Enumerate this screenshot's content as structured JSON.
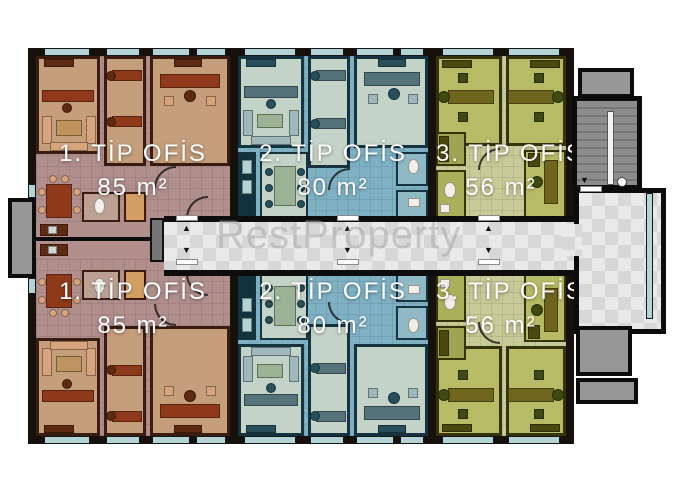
{
  "watermark": "RestProperty",
  "units": [
    {
      "id": "type1-top",
      "type_label": "1. TİP OFİS",
      "area_label": "85 m²"
    },
    {
      "id": "type2-top",
      "type_label": "2. TİP OFİS",
      "area_label": "80 m²"
    },
    {
      "id": "type3-top",
      "type_label": "3. TİP OFİS",
      "area_label": "56 m²"
    },
    {
      "id": "type1-bottom",
      "type_label": "1. TİP OFİS",
      "area_label": "85 m²"
    },
    {
      "id": "type2-bottom",
      "type_label": "2. TİP OFİS",
      "area_label": "80 m²"
    },
    {
      "id": "type3-bottom",
      "type_label": "3. TİP OFİS",
      "area_label": "56 m²"
    }
  ],
  "icons": {
    "up_arrow": "▲",
    "down_arrow": "▼"
  },
  "colors": {
    "wall_dark": "#17110d",
    "u1_floor": "#c59e7b",
    "u1_hall": "#b18f8d",
    "u1_wall": "#3a1c10",
    "u1_desk": "#8e3a1a",
    "u1_sofa": "#d7a47e",
    "u1_cab": "#5e2a12",
    "u1_table": "#c0935f",
    "u1_wc": "#bca193",
    "u1_tile": "#d49e63",
    "u2_floor": "#c4d3c7",
    "u2_hall": "#7fb1c5",
    "u2_wall": "#153440",
    "u2_desk": "#53727a",
    "u2_sofa": "#9fb8bc",
    "u2_cab": "#27505c",
    "u2_table": "#9cb294",
    "u2_kitchen": "#12323e",
    "u2_bath": "#8fb9c4",
    "u3_floor": "#b7bb65",
    "u3_hall": "#c7cb97",
    "u3_wall": "#34330b",
    "u3_desk": "#6f651d",
    "u3_cab": "#4c490e",
    "u3_seat": "#3f4a12",
    "u3_service": "#9fa452",
    "u3_wc": "#aab05a",
    "corridor_a": "#e9e9e9",
    "corridor_b": "#d7d7d7",
    "window": "#b5d3d4",
    "balcony": "#979797",
    "stair": "#8d8d8d",
    "watermark_color": "#a9a9a9",
    "fixture_white": "#f3efe8",
    "shaft": "#757575"
  }
}
